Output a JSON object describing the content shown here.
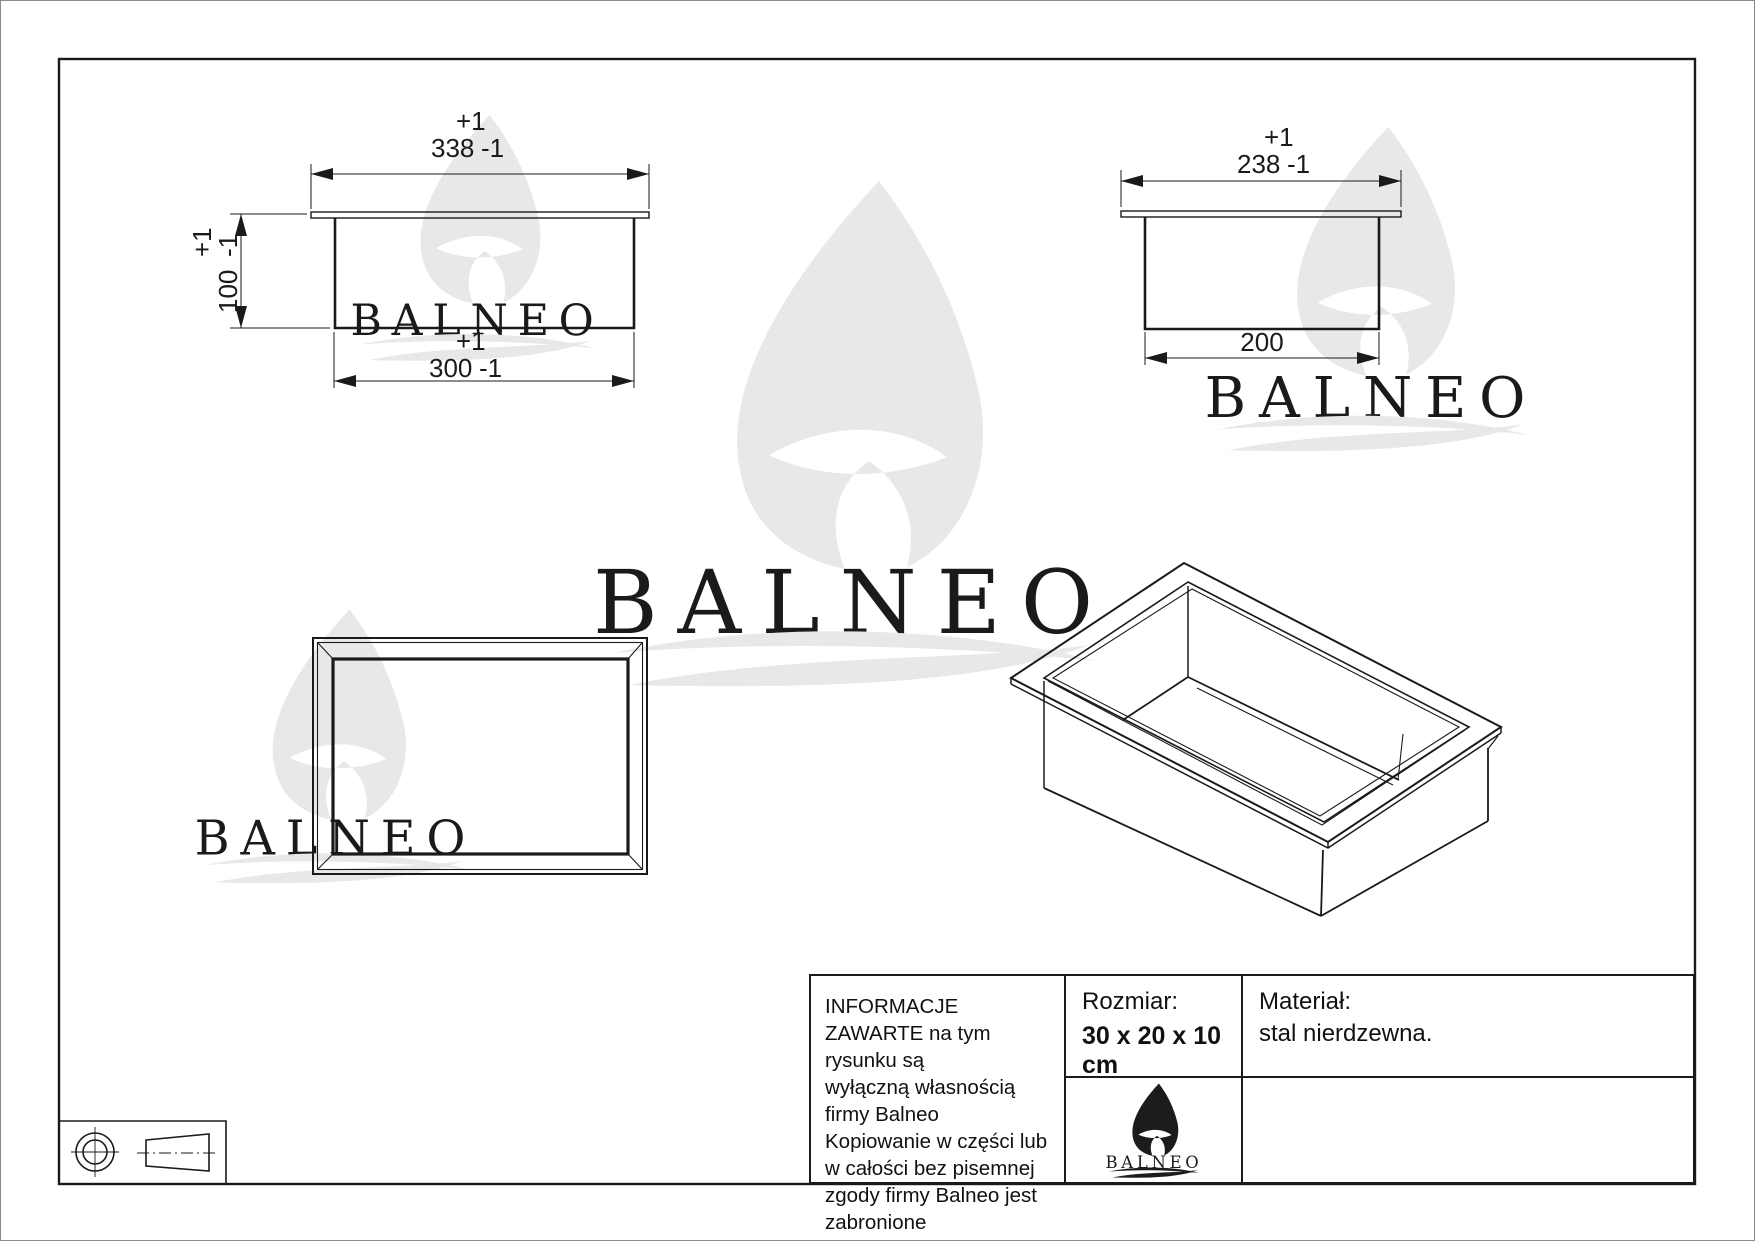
{
  "brand": {
    "name": "BALNEO"
  },
  "dims": {
    "front_width": {
      "plus": "+1",
      "value": "338",
      "minus": "-1"
    },
    "front_height": {
      "plus": "+1",
      "value": "100",
      "minus": "-1"
    },
    "front_inner": {
      "plus": "+1",
      "value": "300",
      "minus": "-1"
    },
    "side_width": {
      "plus": "+1",
      "value": "238",
      "minus": "-1"
    },
    "side_inner": {
      "value": "200"
    }
  },
  "title_block": {
    "info": "INFORMACJE ZAWARTE na tym rysunku są\nwyłączną własnością firmy Balneo\nKopiowanie w części lub w całości bez pisemnej\nzgody firmy Balneo jest zabronione",
    "size_label": "Rozmiar:",
    "size_value": "30 x 20 x 10 cm",
    "material_label": "Materiał:",
    "material_value": "stal nierdzewna."
  },
  "colors": {
    "line": "#1a1a1a",
    "watermark": "#e8e8e8",
    "logo": "#1c1c1c"
  }
}
